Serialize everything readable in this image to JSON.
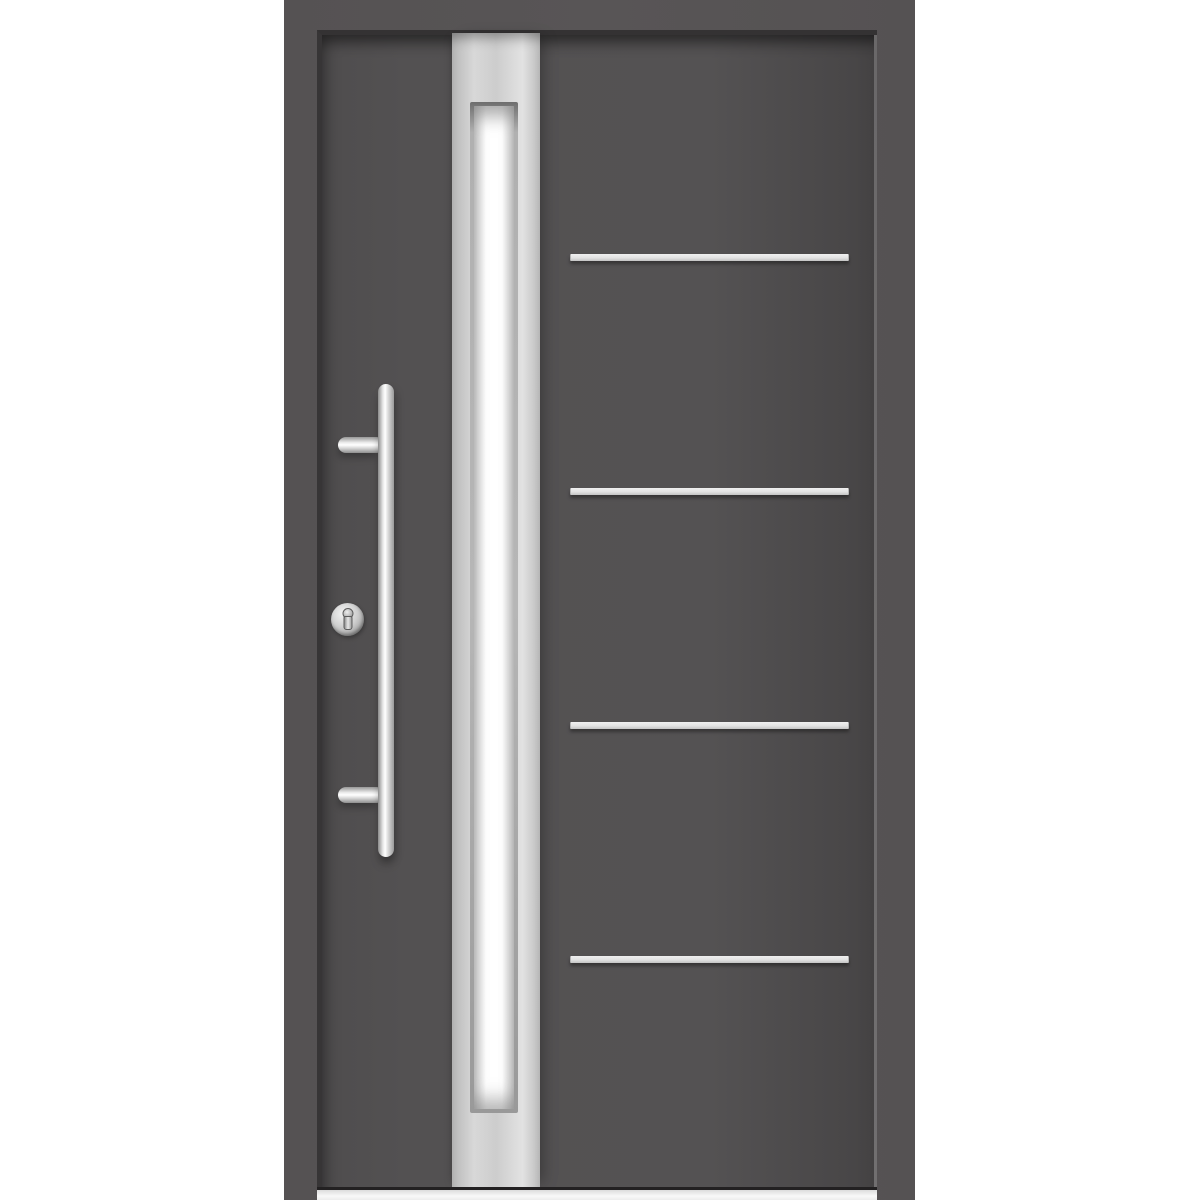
{
  "scene": {
    "type": "product-photo",
    "subject": "Modern anthracite-grey front entry door with full-height stainless glazing strip, frosted vertical glass pane, stainless steel bar pull handle on two mounting posts, round lock cylinder escutcheon, four horizontal stainless trim stripes and a light threshold, shown inside a grey outer frame on a white background",
    "parts": [
      "door-frame",
      "door-leaf",
      "steel-glazing-strip",
      "frosted-glass-pane",
      "trim-stripe-1",
      "trim-stripe-2",
      "trim-stripe-3",
      "trim-stripe-4",
      "pull-handle-bar",
      "handle-mount-post-upper",
      "handle-mount-post-lower",
      "lock-cylinder",
      "threshold"
    ]
  },
  "colors": {
    "background": "#ffffff",
    "frame": "#555253",
    "door_leaf": "#535152",
    "door_leaf_edge": "#434142",
    "gap_shadow": "#373536",
    "leaf_edge_highlight": "#716f70",
    "steel_light": "#d8d8d8",
    "steel_mid": "#cdcdcd",
    "steel_dark": "#999999",
    "glass_white": "#ffffff",
    "glass_edge": "#d4d4d4",
    "stripe_light": "#f0f0f0",
    "stripe_dark": "#c4c4c4",
    "handle_highlight": "#ffffff",
    "handle_shadow": "#8a8a8a",
    "threshold": "#f8f8f8"
  }
}
